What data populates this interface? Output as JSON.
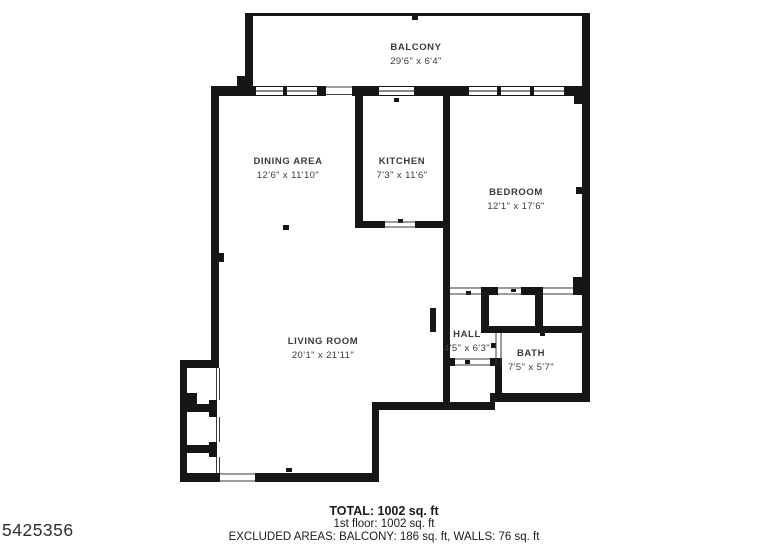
{
  "plan": {
    "rooms": {
      "balcony": {
        "name": "BALCONY",
        "dims": "29'6\" x 6'4\""
      },
      "dining": {
        "name": "DINING AREA",
        "dims": "12'6\" x 11'10\""
      },
      "kitchen": {
        "name": "KITCHEN",
        "dims": "7'3\" x 11'6\""
      },
      "bedroom": {
        "name": "BEDROOM",
        "dims": "12'1\" x 17'6\""
      },
      "living": {
        "name": "LIVING ROOM",
        "dims": "20'1\" x 21'11\""
      },
      "hall": {
        "name": "HALL",
        "dims": "4'5\" x 6'3\""
      },
      "bath": {
        "name": "BATH",
        "dims": "7'5\" x 5'7\""
      }
    },
    "colors": {
      "wall": "#161616",
      "label_text": "#3a3a3a",
      "footer_text": "#1a1a1a"
    }
  },
  "footer": {
    "total": "TOTAL: 1002 sq. ft",
    "floor": "1st floor: 1002 sq. ft",
    "excluded": "EXCLUDED AREAS: BALCONY: 186 sq. ft, WALLS: 76 sq. ft"
  },
  "watermark": {
    "id": "5425356"
  }
}
